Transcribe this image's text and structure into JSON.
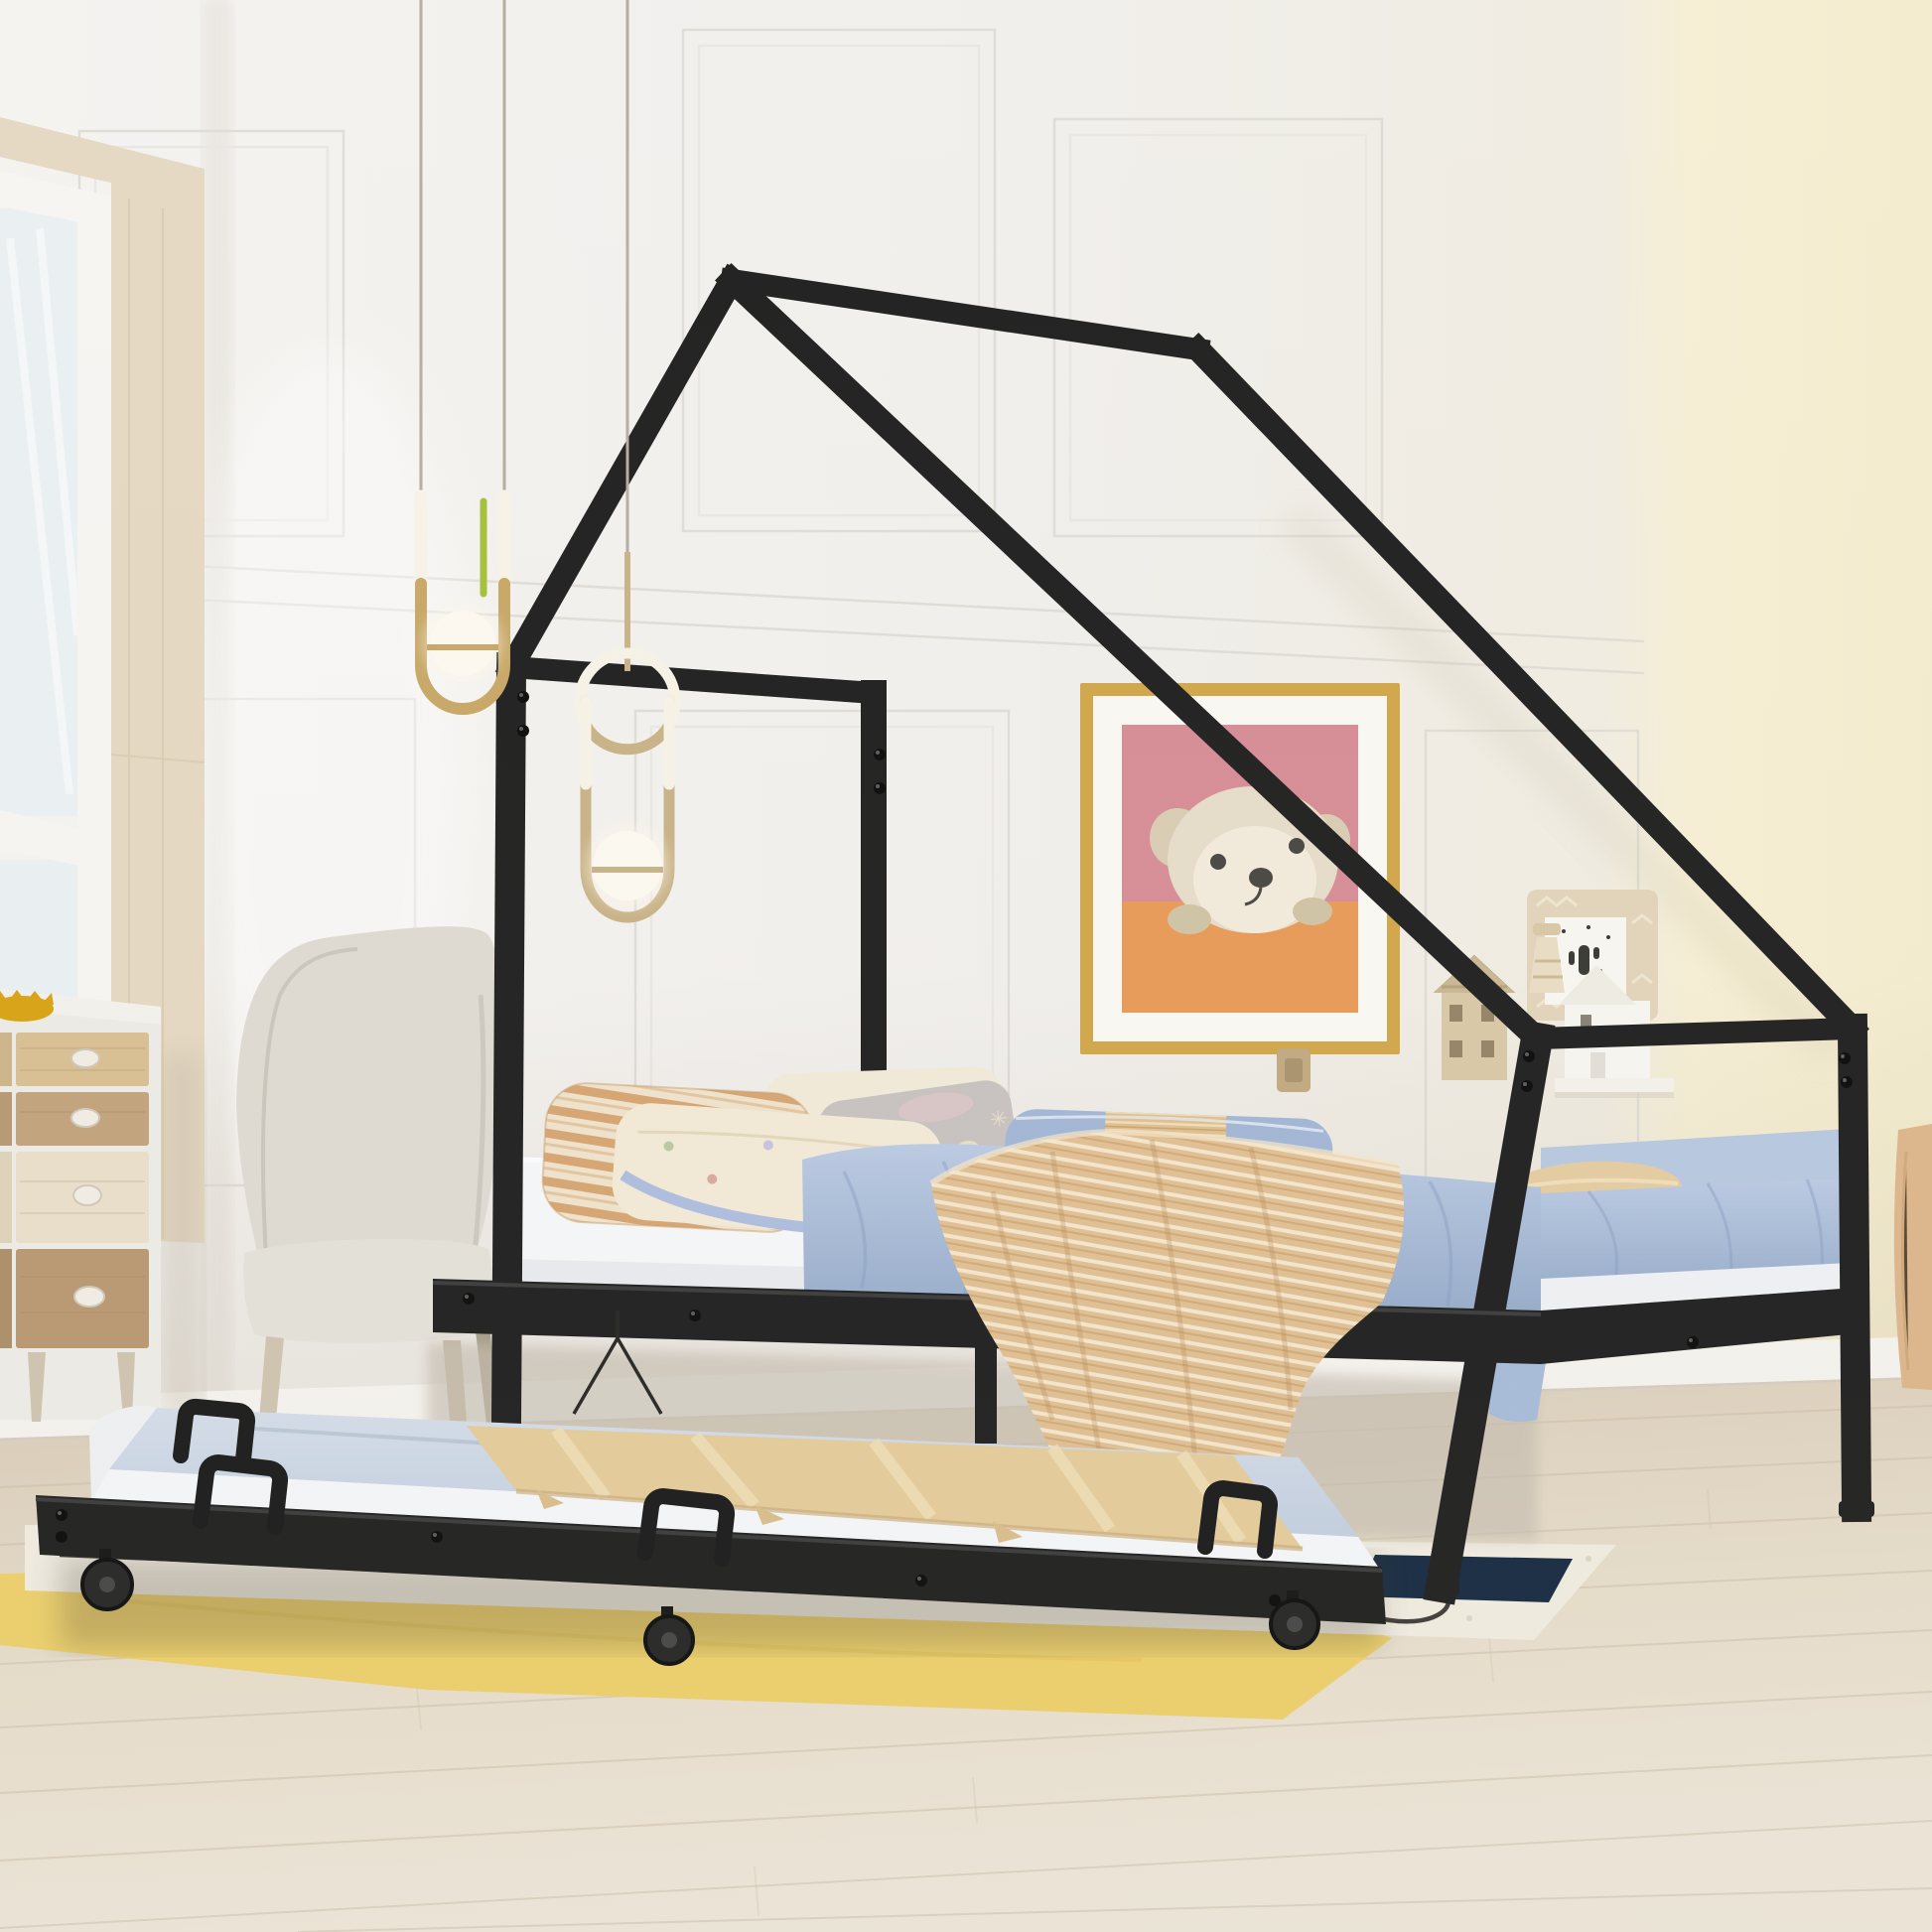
{
  "meta": {
    "title": "Kids twin metal house-shaped bed with pull-out trundle - product photograph",
    "image_type": "furniture product photo, bedroom scene",
    "visible_text_none": "scene contains no UI text; only decorative mirrored letters on a pillow"
  },
  "palette": {
    "frame_black": "#242424",
    "frame_highlight": "#3d3d3d",
    "wall_white": "#f2f1ee",
    "wall_shadow": "#e2dfda",
    "wall_yellow": "#f6efd5",
    "floor_top": "#d8ccb8",
    "floor_bottom": "#ece5d8",
    "plank_line": "#c8bba4",
    "baseboard": "#f4f2ed",
    "rug_yellow": "#ecd06e",
    "rug_white": "#efebe0",
    "rug_navy": "#1b2e44",
    "window_glass": "#eaf0f2",
    "window_trim": "#e5d9c3",
    "dresser_body": "#edebe5",
    "dresser_tan": "#d8c094",
    "dresser_brown": "#c2a47e",
    "dresser_cream": "#e9dfca",
    "dresser_walnut": "#ba9a73",
    "bowl_yellow": "#d9a417",
    "chair_fabric": "#dedbd3",
    "chair_leg": "#cfc5b0",
    "art_frame_gold": "#d2a84e",
    "art_mat": "#faf8f3",
    "art_pink": "#d78f97",
    "art_orange": "#e89c5a",
    "bear_fur": "#e7ddca",
    "bear_face": "#f2ebdb",
    "bear_dark": "#4c4a45",
    "pendant_brass": "#c8a96a",
    "pendant_tube": "#f6f2e6",
    "pendant_globe": "#fcf9f0",
    "pendant_green": "#a6c13c",
    "cord_gray": "#b6ae9e",
    "sheet_white": "#f5f6f7",
    "duvet_blue": "#b5c6e0",
    "duvet_blue_deep": "#96abc9",
    "pillow_stripe_base": "#efe3cd",
    "pillow_stripe": "#d7a674",
    "pillow_cream": "#f2ead6",
    "pillow_gray": "#c8c3c0",
    "pillow_letters_color": "#efe3c9",
    "pillow_blue": "#a3b7d6",
    "pillow_band_tan": "#dfc091",
    "throw_tan": "#e0c094",
    "throw_line": "#f3e6cc",
    "trundle_top_blue": "#ccd6e4",
    "trundle_blanket": "#e4cc9c",
    "shelf_board": "#e3d5bb",
    "shelf_house_white": "#f7f5f0",
    "shelf_house_tan": "#d9c9a8",
    "switch_plate": "#c2ab83",
    "right_edge_wood": "#ddb78d"
  },
  "scene": {
    "description": "Black metal twin-size house-frame bed with asymmetric roof and a rolled-out trundle bed on casters, staged in a bright kids bedroom",
    "room": {
      "back_wall": "white panelled wall with picture-frame mouldings and chair rail",
      "accent_wall": "pale yellow wall on the right",
      "left_wall": "window with light-wood trim",
      "floor": "whitewashed wood planks"
    },
    "furniture": {
      "house_bed": "black square-tube steel frame: tall head posts, peaked roof, long sloped roof beam to shorter foot posts, visible bolts",
      "bed_dressing": "white sheet, light-blue duvet, tan woven throw draped over the side rail",
      "pillows": [
        "tan candy-stripe pillow",
        "cream pillow with tiny prints and blue piping",
        "white back pillow",
        "warm-gray pillow with mirrored cream letters",
        "blue pillow with tan woven band"
      ],
      "trundle": "low black trundle on caster wheels with pale-blue mattress, white sheet band, tan folded blanket and four black U pull handles",
      "dresser": "white dresser with mixed wood-tone drawers and oval knobs, small yellow bowl on top",
      "chair": "light-gray upholstered armchair with wooden legs",
      "wall_art": "gold-framed teddy-bear print, pink and orange background",
      "shelf_decor": "patterned board with cactus card, lighthouse and two little house figurines on a white ledge",
      "rugs": "yellow area rug layered under a cream rug with navy patch and black squiggle line",
      "lighting": "two brass paperclip pendant lights with white glass globes, one with a green cord accent"
    },
    "decor_text": {
      "pillow_letters": "9me"
    }
  }
}
